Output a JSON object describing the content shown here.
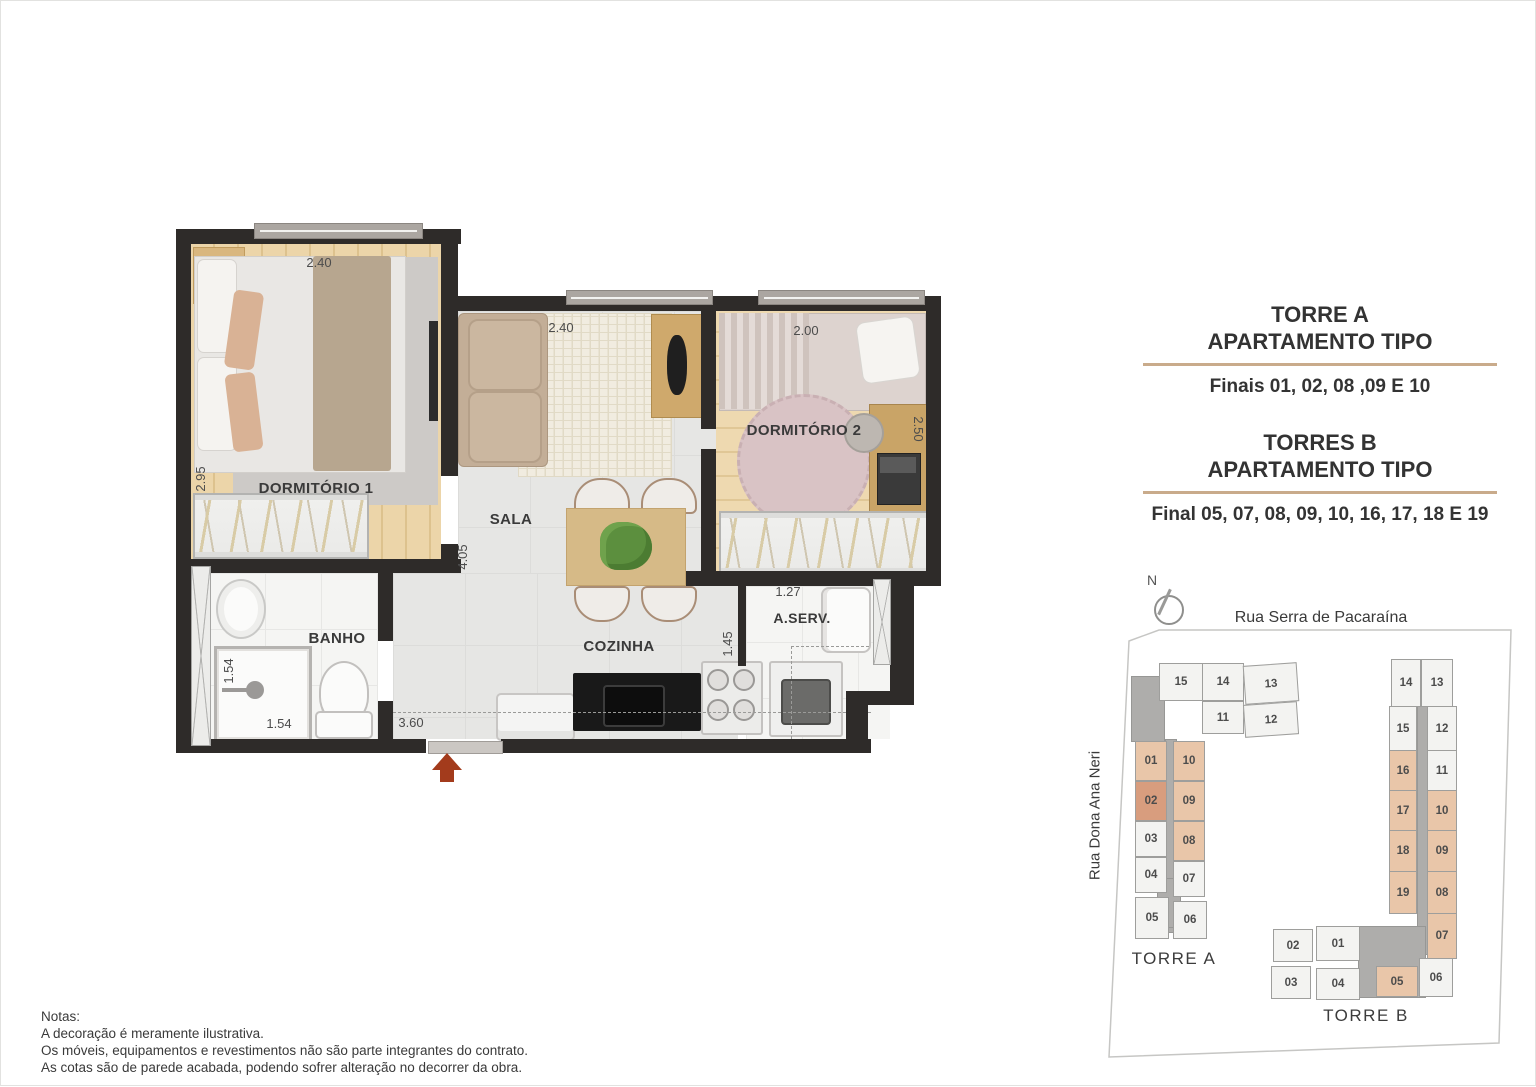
{
  "floorplan": {
    "rooms": {
      "dorm1": "DORMITÓRIO 1",
      "sala": "SALA",
      "dorm2": "DORMITÓRIO 2",
      "banho": "BANHO",
      "cozinha": "COZINHA",
      "aserv": "A.SERV."
    },
    "dims": {
      "dorm1_width": "2.40",
      "dorm1_depth": "2.95",
      "sala_width": "2.40",
      "sala_depth": "4.05",
      "dorm2_width": "2.00",
      "dorm2_depth": "2.50",
      "shower_depth": "1.54",
      "shower_width": "1.54",
      "kitchen_width": "3.60",
      "kitchen_depth": "1.45",
      "aserv_width": "1.27"
    },
    "colors": {
      "wall": "#2e2b29",
      "wood_floor": "#ecd5a9",
      "tile_floor": "#e6e6e4",
      "entrance_arrow": "#a33b1c",
      "counter": "#191919"
    }
  },
  "info_panel": {
    "block_a": {
      "title": "TORRE A",
      "subtitle": "APARTAMENTO TIPO",
      "finals": "Finais 01, 02, 08 ,09 E 10"
    },
    "block_b": {
      "title": "TORRES B",
      "subtitle": "APARTAMENTO TIPO",
      "finals": "Final 05, 07, 08, 09, 10, 16, 17, 18 E 19"
    },
    "divider_color": "#c9ab8b"
  },
  "siteplan": {
    "compass": "N",
    "street_top": "Rua Serra de Pacaraína",
    "street_left": "Rua Dona Ana Neri",
    "colors": {
      "highlight": "#e9c6a9",
      "highlight_dark": "#d89d7e",
      "regular": "#f3f3f1",
      "core": "#aeadab"
    },
    "torre_a": {
      "caption": "TORRE A",
      "units": [
        {
          "label": "15",
          "highlighted": false
        },
        {
          "label": "14",
          "highlighted": false
        },
        {
          "label": "13",
          "highlighted": false
        },
        {
          "label": "11",
          "highlighted": false
        },
        {
          "label": "12",
          "highlighted": false
        },
        {
          "label": "01",
          "highlighted": true
        },
        {
          "label": "10",
          "highlighted": true
        },
        {
          "label": "02",
          "highlighted": true
        },
        {
          "label": "09",
          "highlighted": true
        },
        {
          "label": "03",
          "highlighted": false
        },
        {
          "label": "08",
          "highlighted": true
        },
        {
          "label": "04",
          "highlighted": false
        },
        {
          "label": "07",
          "highlighted": false
        },
        {
          "label": "05",
          "highlighted": false
        },
        {
          "label": "06",
          "highlighted": false
        }
      ]
    },
    "torre_b": {
      "caption": "TORRE B",
      "units": [
        {
          "label": "14",
          "highlighted": false
        },
        {
          "label": "13",
          "highlighted": false
        },
        {
          "label": "15",
          "highlighted": false
        },
        {
          "label": "12",
          "highlighted": false
        },
        {
          "label": "16",
          "highlighted": true
        },
        {
          "label": "11",
          "highlighted": false
        },
        {
          "label": "17",
          "highlighted": true
        },
        {
          "label": "10",
          "highlighted": true
        },
        {
          "label": "18",
          "highlighted": true
        },
        {
          "label": "09",
          "highlighted": true
        },
        {
          "label": "19",
          "highlighted": true
        },
        {
          "label": "08",
          "highlighted": true
        },
        {
          "label": "07",
          "highlighted": true
        },
        {
          "label": "02",
          "highlighted": false
        },
        {
          "label": "01",
          "highlighted": false
        },
        {
          "label": "03",
          "highlighted": false
        },
        {
          "label": "04",
          "highlighted": false
        },
        {
          "label": "05",
          "highlighted": true
        },
        {
          "label": "06",
          "highlighted": false
        }
      ]
    }
  },
  "notes": {
    "title": "Notas:",
    "lines": [
      "A decoração é meramente ilustrativa.",
      "Os móveis, equipamentos e revestimentos não são parte integrantes do contrato.",
      "As cotas são de parede acabada, podendo sofrer alteração no decorrer da obra."
    ]
  }
}
